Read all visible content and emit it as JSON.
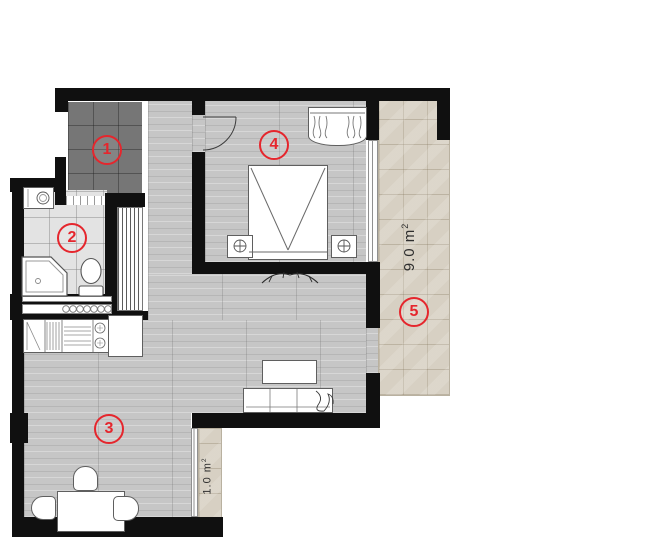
{
  "plan_title": "apartment-floor-plan",
  "markers": [
    "1",
    "2",
    "3",
    "4",
    "5"
  ],
  "areas": {
    "balcony": {
      "value": "9.0 m",
      "sup": "2"
    },
    "small_balcony": {
      "value": "1.0 m",
      "sup": "2"
    }
  },
  "colors": {
    "wall": "#101010",
    "marker_red": "#e5262d",
    "wood_floor": "#c6c6c6",
    "dark_tile": "#767676",
    "bath_tile": "#e3e3e3",
    "balcony_tile": "#d7d0c3"
  }
}
